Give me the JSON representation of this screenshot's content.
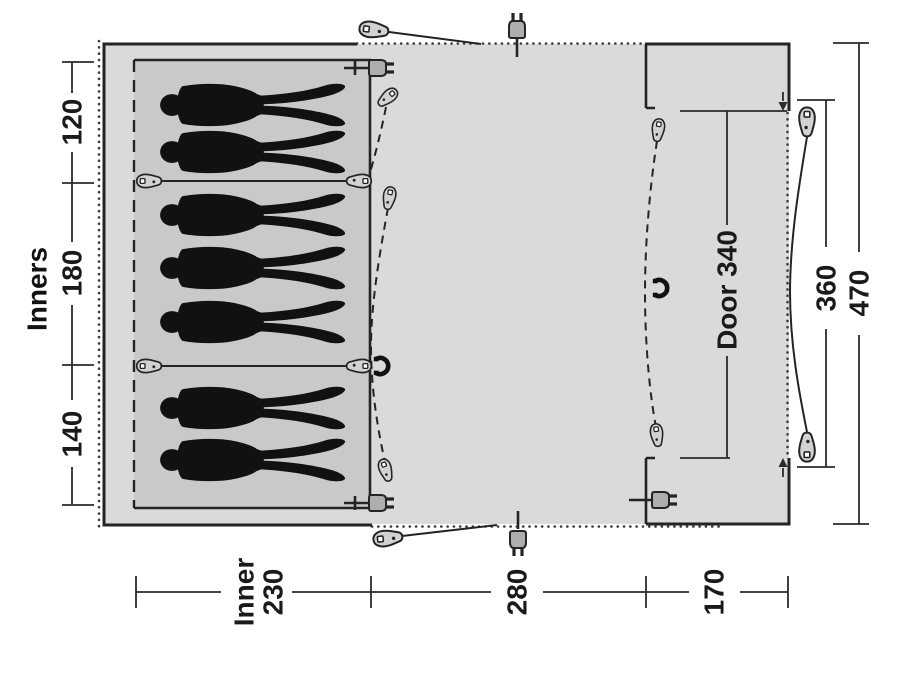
{
  "diagram": {
    "type": "tent-floorplan-top-view",
    "sleeping_capacity_figures": 7,
    "labels": {
      "inners_title": "Inners",
      "inner_section_top": "120",
      "inner_section_middle": "180",
      "inner_section_bottom": "140",
      "door_width": "Door 340",
      "front_width": "360",
      "total_width": "470",
      "bottom_inner_word": "Inner",
      "bottom_inner_value": "230",
      "bottom_middle": "280",
      "bottom_front": "170"
    },
    "icons": {
      "peg": "tent-peg-icon",
      "zipper_pull": "zipper-pull-icon",
      "power_plug": "power-plug-icon",
      "toggle": "magnet-toggle-icon",
      "person": "sleeping-person-silhouette"
    },
    "colors": {
      "canvas": "#ffffff",
      "floor": "#dadada",
      "inner_floor": "#c9c9c9",
      "line": "#242424",
      "dimension_line": "#2b2b2b",
      "figure": "#111111",
      "icon_fill": "#d2d2d2",
      "plug_fill": "#aeaeae"
    }
  }
}
